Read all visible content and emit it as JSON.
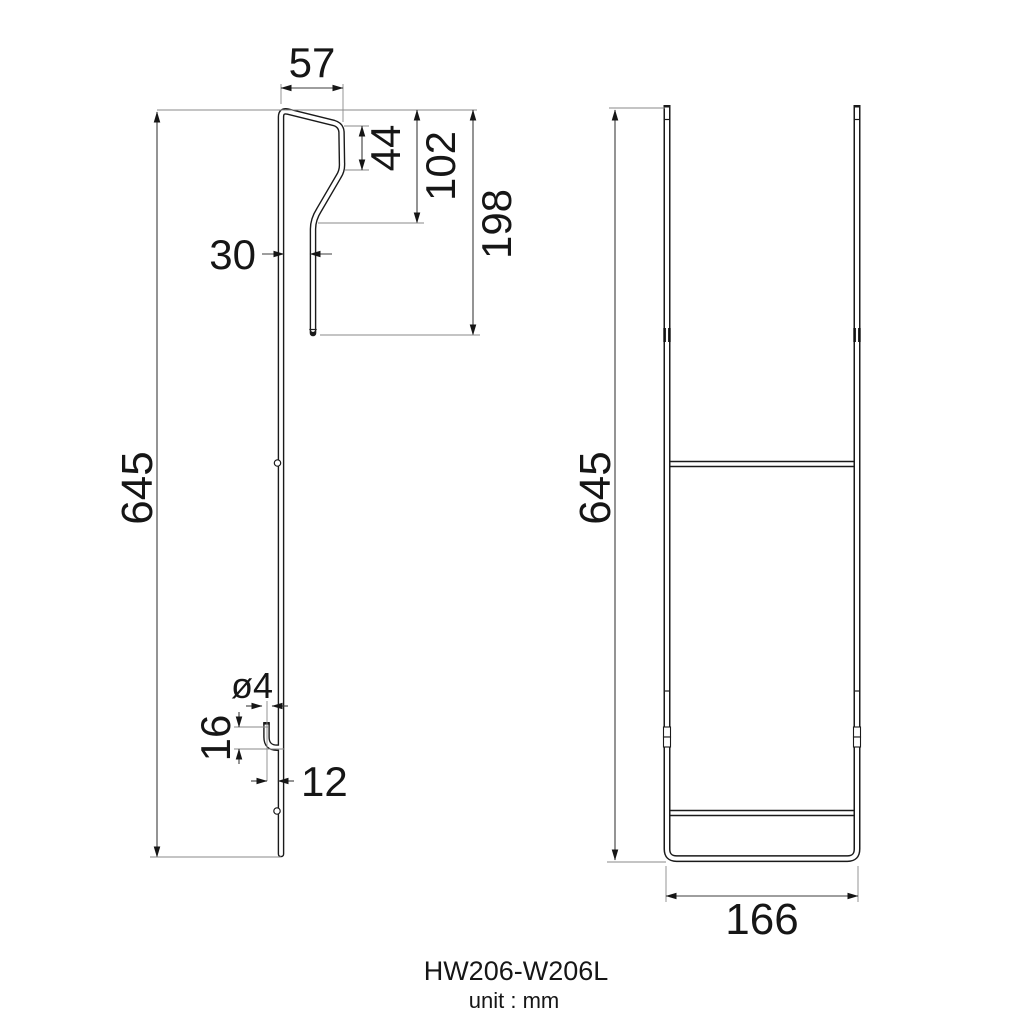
{
  "drawing": {
    "outline_color": "#1a1a1a",
    "dimension_line_color": "#3d3d3d",
    "extension_line_color": "#8a8a8a",
    "background_color": "#ffffff"
  },
  "side_view": {
    "dims": {
      "hook_top_width": "57",
      "hook_upper_height": "44",
      "hook_mid_height": "102",
      "hook_overall_height": "198",
      "hook_gap": "30",
      "overall_height": "645",
      "wire_diameter": "ø4",
      "lower_hook_height": "16",
      "lower_hook_gap": "12"
    }
  },
  "front_view": {
    "dims": {
      "overall_height": "645",
      "overall_width": "166"
    }
  },
  "title_block": {
    "model": "HW206-W206L",
    "unit": "unit : mm"
  }
}
